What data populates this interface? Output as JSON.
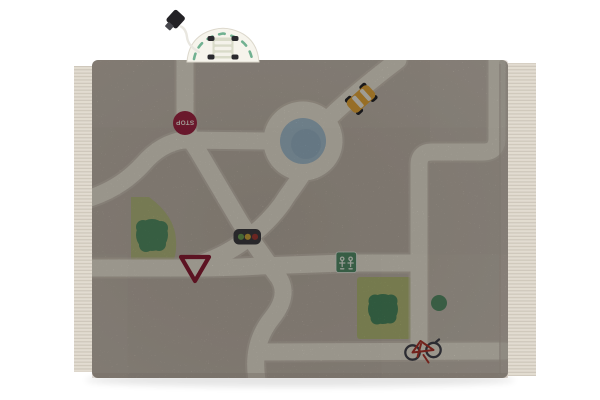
{
  "scene": {
    "type": "product-photo",
    "subject": "children's washable play rug with a city road-map design, toy van resting on top edge",
    "background_color": "#ffffff"
  },
  "rug": {
    "base_color": "#c8beb2",
    "road_color": "#ece6d7",
    "road_shadow_color": "#d7cec0",
    "fringe_color": "#e2dcd1",
    "fringe_strand_color": "#ccc5b8",
    "binding_color": "#cfc5b9"
  },
  "map_elements": {
    "stop_sign": {
      "label": "STOP",
      "fill": "#a22745",
      "text_color": "#f2ece2"
    },
    "pond": {
      "fill": "#a7c1d1",
      "fill_dark": "#93b0c3"
    },
    "park_left": {
      "grass": "#b8bc81",
      "tree": "#579168"
    },
    "park_right": {
      "grass": "#b5bc79",
      "tree": "#4c8a60"
    },
    "small_bush": {
      "fill": "#4c8a60"
    },
    "playground_sign": {
      "fill": "#55906b",
      "glyph": "#eaf0e5"
    },
    "yield_sign": {
      "stroke": "#8f1f36"
    },
    "traffic_light": {
      "body": "#3f3e42",
      "green": "#6fa054",
      "amber": "#d1a93e",
      "red": "#a53c35"
    },
    "taxi": {
      "body": "#e7a83b",
      "window": "#f3efe3",
      "wheel": "#26262a"
    },
    "bicycle": {
      "wheel": "#45454d",
      "frame": "#ae352c"
    }
  },
  "toy": {
    "shell": "#f6f4ec",
    "accent": "#71b191",
    "body": "#d9dbc9",
    "stripe": "#f4f2ea",
    "wheel": "#2a2a2e",
    "cord": "#e9e7e0",
    "tag": "#232226",
    "tag_tip": "#46464c"
  }
}
